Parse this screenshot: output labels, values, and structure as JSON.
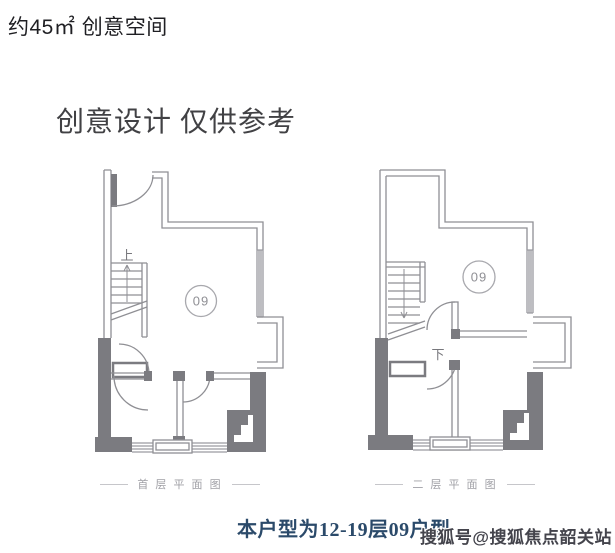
{
  "header": {
    "area_label": "约45㎡ 创意空间"
  },
  "title": {
    "text": "创意设计 仅供参考"
  },
  "plans": {
    "unit_number": "09",
    "first_floor": {
      "caption": "首 层 平 面 图",
      "stair_label": "上"
    },
    "second_floor": {
      "caption": "二 层 平 面 图",
      "stair_label": "下"
    }
  },
  "footer": {
    "unit_note": "本户型为12-19层09户型"
  },
  "watermark": {
    "text": "搜狐号@搜狐焦点韶关站"
  },
  "colors": {
    "wall_line": "#8f8f94",
    "wall_fill": "#7b7b80",
    "window_line": "#9a9aa0",
    "header_text": "#1f1f23",
    "title_text": "#414144",
    "caption_text": "#a0a0a6",
    "note_text": "#2b4a6a",
    "watermark_text": "#44444c"
  }
}
